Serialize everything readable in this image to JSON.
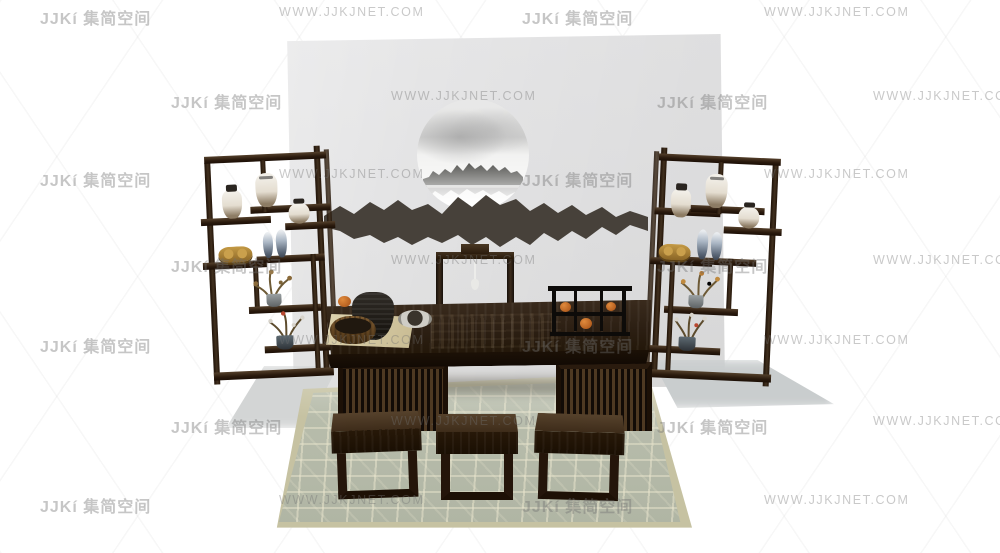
{
  "watermark": {
    "logo_text": "JJKí 集简空间",
    "url_text": "WWW.JJKJNET.COM"
  },
  "palette": {
    "background": "#ffffff",
    "backdrop_panel": "#e4e4e5",
    "dark_wood": "#2e2014",
    "wood_highlight": "#54402b",
    "mountain_art": "#47413a",
    "rug_base": "#b5baa9",
    "rug_border": "#c6c2a2",
    "rug_pattern": "#e6e2cc",
    "porcelain": "#ece7dc",
    "blue_porcelain": "#aab6c4",
    "gold_ornament": "#c49a45",
    "persimmon_orange": "#c96f2a",
    "watermark_gray": "#c9c9c9",
    "shadow_gray": "#ced1d1"
  }
}
